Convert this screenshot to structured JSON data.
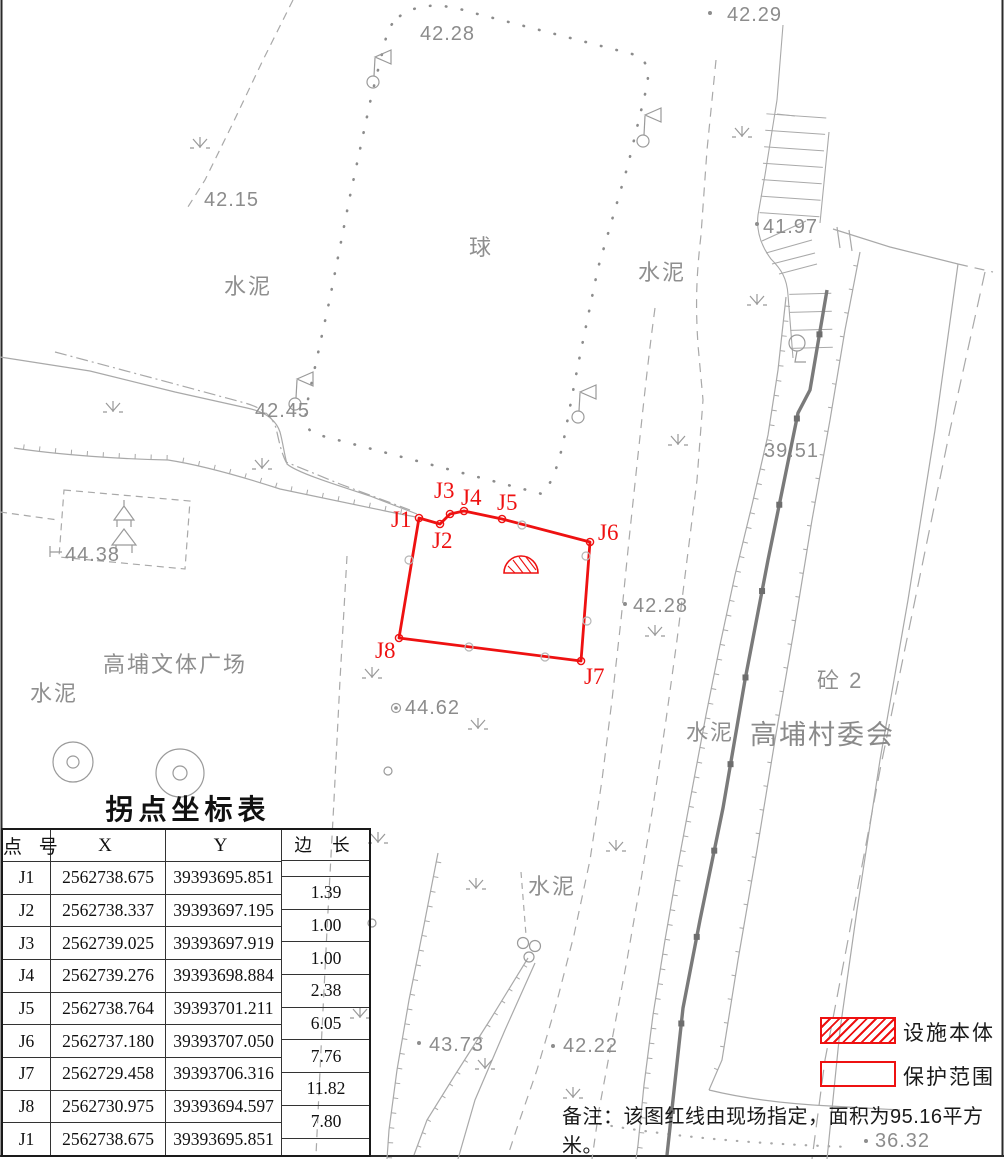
{
  "map": {
    "labels": {
      "court": "球",
      "cement": "水泥",
      "plaza": "高埔文体广场",
      "village_committee": "高埔村委会",
      "concrete_2": "砼 2"
    },
    "spot_heights": {
      "top": "42.28",
      "top_right": "42.29",
      "upper_left": "42.15",
      "stairs": "41.97",
      "road_left": "42.45",
      "house": "44.38",
      "plaza_point": "44.62",
      "mid_right": "42.28",
      "wall": "39.51",
      "bottom_left": "43.73",
      "bottom_mid": "42.22",
      "bottom_right": "36.32"
    },
    "boundary_points": {
      "j1": "J1",
      "j2": "J2",
      "j3": "J3",
      "j4": "J4",
      "j5": "J5",
      "j6": "J6",
      "j7": "J7",
      "j8": "J8"
    }
  },
  "table": {
    "title": "拐点坐标表",
    "headers": {
      "point": "点 号",
      "x": "X",
      "y": "Y",
      "length": "边 长"
    },
    "rows": [
      {
        "id": "J1",
        "x": "2562738.675",
        "y": "39393695.851"
      },
      {
        "id": "J2",
        "x": "2562738.337",
        "y": "39393697.195"
      },
      {
        "id": "J3",
        "x": "2562739.025",
        "y": "39393697.919"
      },
      {
        "id": "J4",
        "x": "2562739.276",
        "y": "39393698.884"
      },
      {
        "id": "J5",
        "x": "2562738.764",
        "y": "39393701.211"
      },
      {
        "id": "J6",
        "x": "2562737.180",
        "y": "39393707.050"
      },
      {
        "id": "J7",
        "x": "2562729.458",
        "y": "39393706.316"
      },
      {
        "id": "J8",
        "x": "2562730.975",
        "y": "39393694.597"
      },
      {
        "id": "J1",
        "x": "2562738.675",
        "y": "39393695.851"
      }
    ],
    "side_lengths": [
      "1.39",
      "1.00",
      "1.00",
      "2.38",
      "6.05",
      "7.76",
      "11.82",
      "7.80"
    ]
  },
  "legend": {
    "facility_label": "设施本体",
    "protection_label": "保护范围"
  },
  "note": "备注：该图红线由现场指定，面积为95.16平方米。",
  "colors": {
    "red": "#ee1111",
    "map_line": "#a9a9a9",
    "wall_line": "#7a7a7a",
    "map_text": "#8c8c8c",
    "table_line": "#1a1a1a"
  }
}
